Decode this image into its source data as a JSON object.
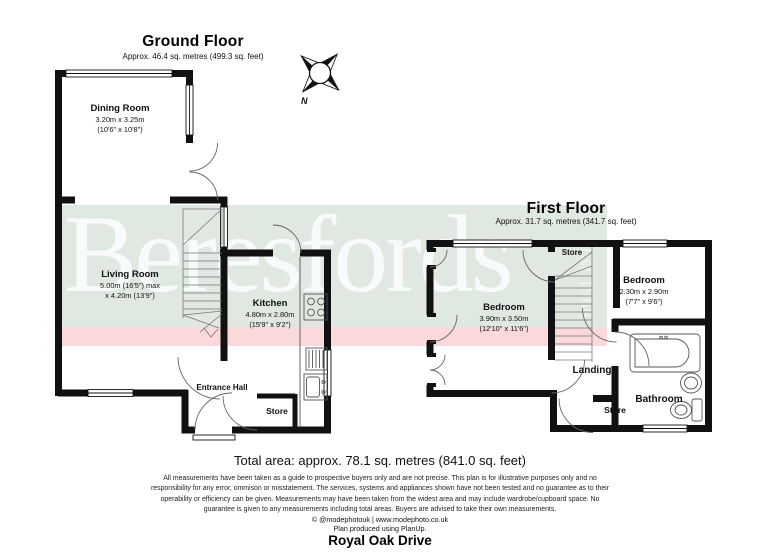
{
  "watermark": {
    "brand": "Beresfords",
    "established": "Est 1968",
    "band_green": "#dfe9e2",
    "band_pink": "#fbd8da"
  },
  "compass": {
    "label": "N"
  },
  "ground_floor": {
    "title": "Ground Floor",
    "subtitle": "Approx. 46.4 sq. metres (499.3 sq. feet)",
    "dining": {
      "name": "Dining Room",
      "metric": "3.20m x 3.25m",
      "imperial": "(10'6\" x 10'8\")"
    },
    "living": {
      "name": "Living Room",
      "metric": "5.00m (16'5\") max",
      "imperial": "x 4.20m (13'9\")"
    },
    "kitchen": {
      "name": "Kitchen",
      "metric": "4.80m x 2.80m",
      "imperial": "(15'9\" x 9'2\")"
    },
    "entrance_hall": {
      "name": "Entrance Hall"
    },
    "store": {
      "name": "Store"
    }
  },
  "first_floor": {
    "title": "First Floor",
    "subtitle": "Approx. 31.7 sq. metres (341.7 sq. feet)",
    "store_top": {
      "name": "Store"
    },
    "bedroom_left": {
      "name": "Bedroom",
      "metric": "3.90m x 3.50m",
      "imperial": "(12'10\" x 11'6\")"
    },
    "bedroom_right": {
      "name": "Bedroom",
      "metric": "2.30m x 2.90m",
      "imperial": "(7'7\" x 9'6\")"
    },
    "landing": {
      "name": "Landing"
    },
    "store_bottom": {
      "name": "Store"
    },
    "bathroom": {
      "name": "Bathroom"
    }
  },
  "footer": {
    "total_area": "Total area: approx. 78.1 sq. metres (841.0 sq. feet)",
    "disclaimer_lines": [
      "All measurements have been taken as a guide to prospective buyers only and are not precise. This plan is for illustrative purposes only and no",
      "responsibility for any error, ommison or misstatement. The services, systems and appliances shown have not been tested and no guarantee as to their",
      "operability or efficiency can be given. Measurements may have been taken from the widest area and may include wardrobe/cupboard space. No",
      "guarantee is given to any measurements including total areas. Buyers are advised to take their own measurements."
    ],
    "credit": "© @modephotouk | www.modephoto.co.uk",
    "produced": "Plan produced using PlanUp.",
    "address": "Royal Oak Drive"
  }
}
